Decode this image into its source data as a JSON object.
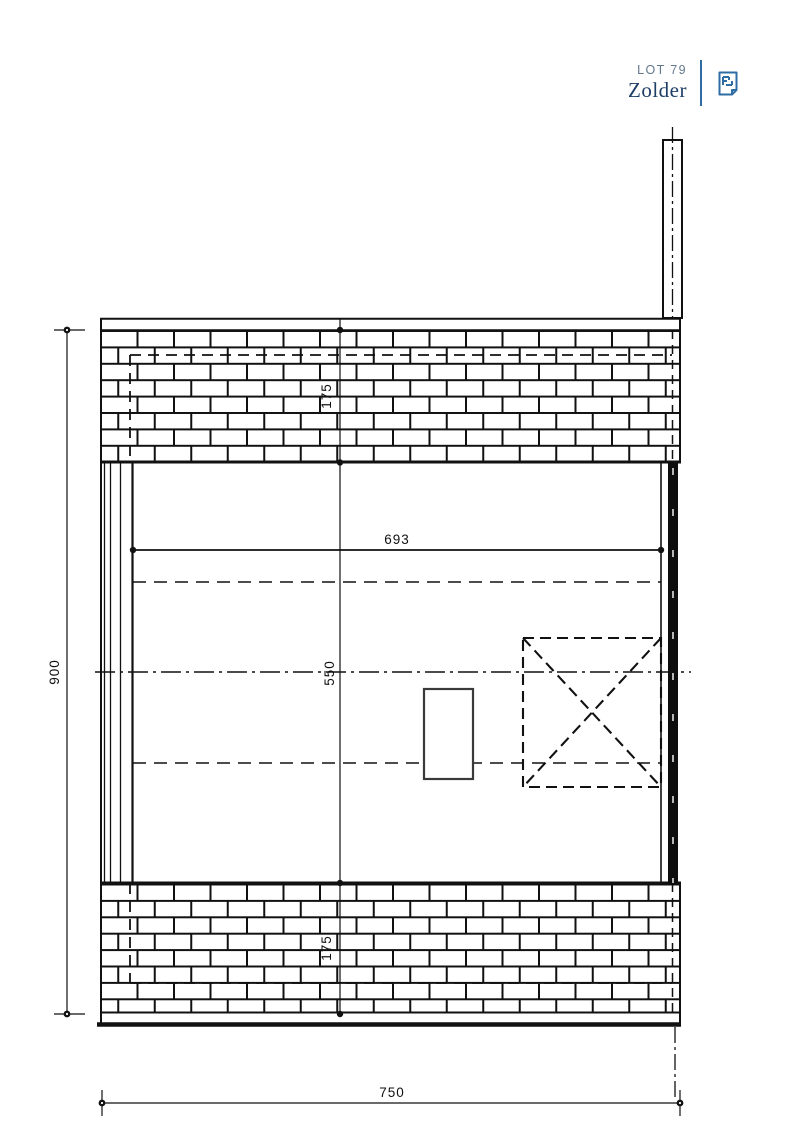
{
  "header": {
    "lot_label": "LOT 79",
    "title": "Zolder"
  },
  "plan": {
    "dim_overall_height": "900",
    "dim_overall_width": "750",
    "dim_inner_width": "693",
    "dim_inner_height": "550",
    "dim_top_wall": "175",
    "dim_bottom_wall": "175"
  },
  "colors": {
    "accent": "#2e6da4",
    "title_navy": "#1d3f66",
    "lot_gray": "#64788c",
    "line": "#111111"
  }
}
